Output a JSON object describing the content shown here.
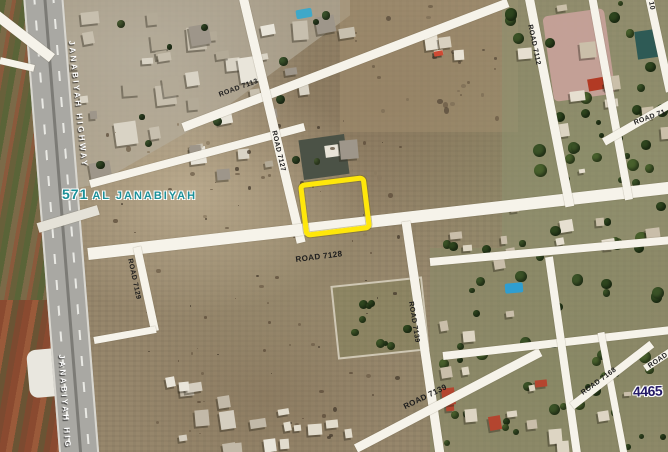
{
  "map": {
    "description": "Satellite view of land plot in Al Janabiyah block 571",
    "highlight_color": "#ffe70a",
    "block_label": {
      "number": "571",
      "name": "AL JANABIYAH",
      "color": "#1b9099"
    },
    "plot_number": "4465",
    "highway_labels": {
      "top": "JANABIYAH HIGHWAY",
      "bottom": "JANABIYAH HIG"
    },
    "road_labels": [
      {
        "text": "ROAD 7113"
      },
      {
        "text": "ROAD 7127"
      },
      {
        "text": "ROAD 7128"
      },
      {
        "text": "ROAD 7129"
      },
      {
        "text": "ROAD 7139"
      },
      {
        "text": "ROAD 7139"
      },
      {
        "text": "ROAD 7112"
      },
      {
        "text": "ROAD 7168"
      },
      {
        "text": "ROAD 71"
      },
      {
        "text": "ROAD"
      },
      {
        "text": "10"
      }
    ]
  }
}
